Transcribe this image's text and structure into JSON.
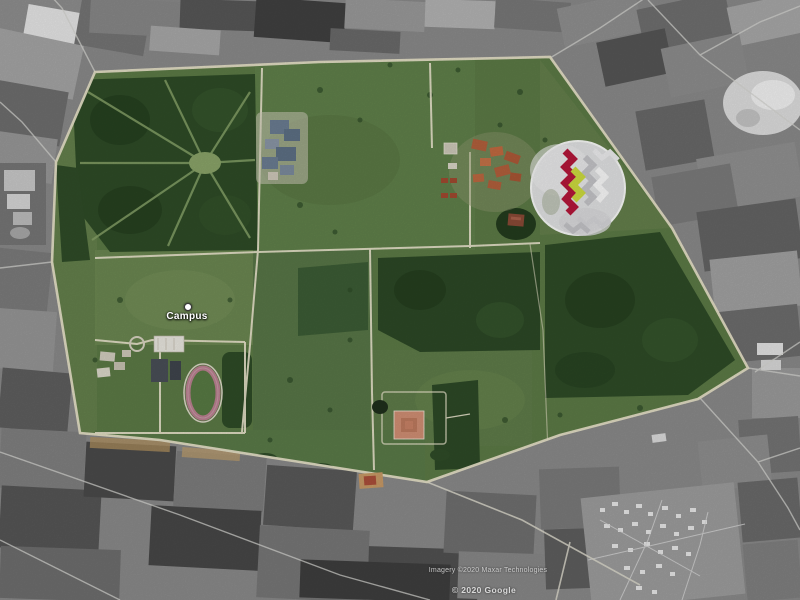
{
  "app": {
    "name": "satellite-map-view"
  },
  "map": {
    "placemark": {
      "label": "Campus"
    },
    "attribution": {
      "imagery_credit": "Imagery ©2020 Maxar Technologies",
      "branding": "© 2020 Google"
    },
    "inset": {
      "description": "zigzag-hostel-block-highlight",
      "highlight_primary": "#b5173a",
      "highlight_secondary": "#cddc3f"
    },
    "colors": {
      "campus_green": "#5c7a46",
      "forest_green": "#2e4b27",
      "road_light": "#e9e3cc",
      "surround_gray": "#8a8a8a",
      "track_pink": "#bb8191"
    }
  }
}
